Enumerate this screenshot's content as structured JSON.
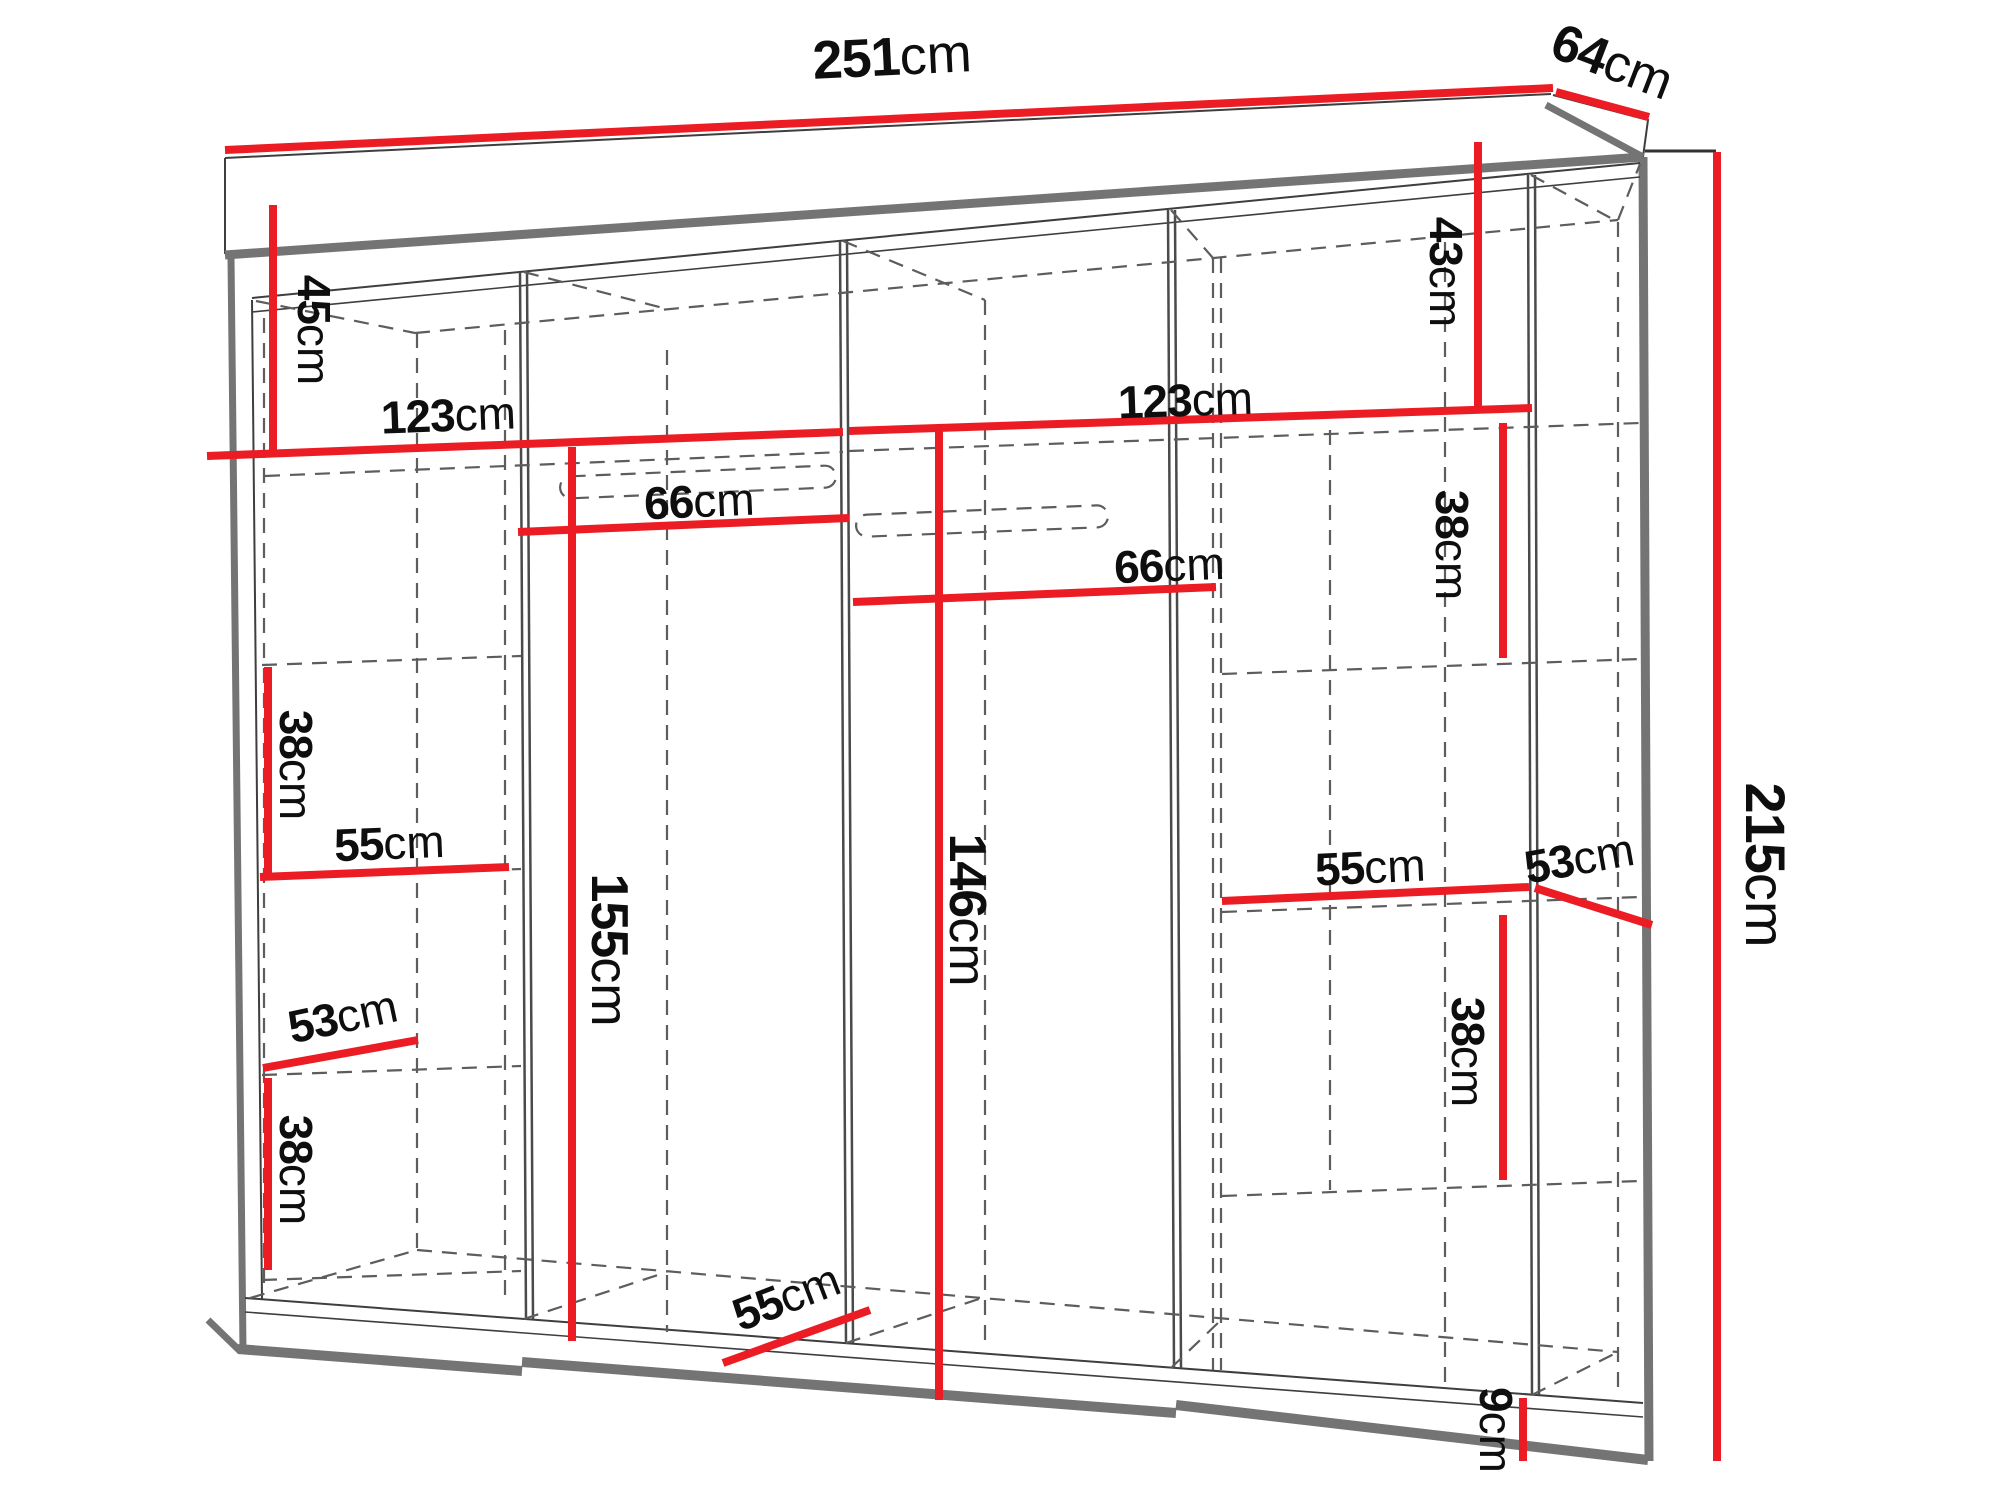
{
  "diagram": {
    "subject": "wardrobe-dimension-drawing",
    "unit": "cm"
  },
  "colors": {
    "dimension_line": "#ec1c24",
    "structure_thick": "#757575",
    "structure_thin": "#3e3e3e",
    "hidden_dashed": "#5d5d5d",
    "text": "#0e0e0e",
    "background": "#ffffff"
  },
  "dimensions": [
    {
      "id": "overall-width",
      "num": "251",
      "unit": "cm",
      "value_cm": 251,
      "line": [
        [
          225,
          150
        ],
        [
          1553,
          88
        ]
      ],
      "label": {
        "x": 893,
        "y": 75,
        "rot": -2.8,
        "size": 54
      }
    },
    {
      "id": "overall-depth",
      "num": "64",
      "unit": "cm",
      "value_cm": 64,
      "line": [
        [
          1556,
          92
        ],
        [
          1649,
          117
        ]
      ],
      "label": {
        "x": 1606,
        "y": 78,
        "rot": 21,
        "size": 52
      }
    },
    {
      "id": "overall-height",
      "num": "215",
      "unit": "cm",
      "value_cm": 215,
      "line": [
        [
          1717,
          152
        ],
        [
          1717,
          1461
        ]
      ],
      "tick": [
        [
          1645,
          151
        ],
        [
          1716,
          151
        ]
      ],
      "label": {
        "x": 1746,
        "y": 865,
        "rot": 90,
        "size": 56
      }
    },
    {
      "id": "top-left-45",
      "num": "45",
      "unit": "cm",
      "value_cm": 45,
      "line": [
        [
          273,
          205
        ],
        [
          273,
          453
        ]
      ],
      "label": {
        "x": 298,
        "y": 330,
        "rot": 90,
        "size": 46
      }
    },
    {
      "id": "top-right-43",
      "num": "43",
      "unit": "cm",
      "value_cm": 43,
      "line": [
        [
          1478,
          142
        ],
        [
          1478,
          410
        ]
      ],
      "label": {
        "x": 1430,
        "y": 272,
        "rot": 90,
        "size": 46
      }
    },
    {
      "id": "left-width-123",
      "num": "123",
      "unit": "cm",
      "value_cm": 123,
      "line": [
        [
          207,
          456
        ],
        [
          843,
          432
        ]
      ],
      "label": {
        "x": 449,
        "y": 431,
        "rot": -2.2,
        "size": 46
      }
    },
    {
      "id": "right-width-123",
      "num": "123",
      "unit": "cm",
      "value_cm": 123,
      "line": [
        [
          849,
          431
        ],
        [
          1532,
          408
        ]
      ],
      "label": {
        "x": 1186,
        "y": 416,
        "rot": -2,
        "size": 46
      }
    },
    {
      "id": "left-rail-66",
      "num": "66",
      "unit": "cm",
      "value_cm": 66,
      "line": [
        [
          518,
          532
        ],
        [
          849,
          518
        ]
      ],
      "label": {
        "x": 700,
        "y": 517,
        "rot": -2.4,
        "size": 46
      }
    },
    {
      "id": "right-rail-66",
      "num": "66",
      "unit": "cm",
      "value_cm": 66,
      "line": [
        [
          853,
          602
        ],
        [
          1216,
          587
        ]
      ],
      "label": {
        "x": 1170,
        "y": 581,
        "rot": -2.3,
        "size": 46
      }
    },
    {
      "id": "mid-height-155",
      "num": "155",
      "unit": "cm",
      "value_cm": 155,
      "line": [
        [
          572,
          447
        ],
        [
          572,
          1341
        ]
      ],
      "label": {
        "x": 592,
        "y": 950,
        "rot": 90,
        "size": 52
      }
    },
    {
      "id": "mid-height-146",
      "num": "146",
      "unit": "cm",
      "value_cm": 146,
      "line": [
        [
          939,
          427
        ],
        [
          939,
          1400
        ]
      ],
      "label": {
        "x": 950,
        "y": 910,
        "rot": 90,
        "size": 52
      }
    },
    {
      "id": "left-shelf-38-upper",
      "num": "38",
      "unit": "cm",
      "value_cm": 38,
      "line": [
        [
          268,
          667
        ],
        [
          268,
          875
        ]
      ],
      "label": {
        "x": 280,
        "y": 765,
        "rot": 90,
        "size": 46
      }
    },
    {
      "id": "left-shelf-55",
      "num": "55",
      "unit": "cm",
      "value_cm": 55,
      "line": [
        [
          260,
          877
        ],
        [
          509,
          867
        ]
      ],
      "label": {
        "x": 390,
        "y": 859,
        "rot": -2.3,
        "size": 46
      }
    },
    {
      "id": "left-depth-53",
      "num": "53",
      "unit": "cm",
      "value_cm": 53,
      "line": [
        [
          263,
          1068
        ],
        [
          418,
          1040
        ]
      ],
      "label": {
        "x": 346,
        "y": 1032,
        "rot": -12,
        "size": 46
      }
    },
    {
      "id": "left-shelf-38-lower",
      "num": "38",
      "unit": "cm",
      "value_cm": 38,
      "line": [
        [
          268,
          1078
        ],
        [
          268,
          1270
        ]
      ],
      "label": {
        "x": 280,
        "y": 1170,
        "rot": 90,
        "size": 46
      }
    },
    {
      "id": "bottom-depth-55",
      "num": "55",
      "unit": "cm",
      "value_cm": 55,
      "line": [
        [
          723,
          1363
        ],
        [
          870,
          1310
        ]
      ],
      "label": {
        "x": 792,
        "y": 1312,
        "rot": -21,
        "size": 46
      }
    },
    {
      "id": "right-shelf-55",
      "num": "55",
      "unit": "cm",
      "value_cm": 55,
      "line": [
        [
          1222,
          901
        ],
        [
          1529,
          887
        ]
      ],
      "label": {
        "x": 1371,
        "y": 883,
        "rot": -2.6,
        "size": 46
      }
    },
    {
      "id": "right-depth-53",
      "num": "53",
      "unit": "cm",
      "value_cm": 53,
      "line": [
        [
          1535,
          888
        ],
        [
          1652,
          925
        ]
      ],
      "label": {
        "x": 1582,
        "y": 874,
        "rot": -10,
        "size": 46
      }
    },
    {
      "id": "right-shelf-38-upper",
      "num": "38",
      "unit": "cm",
      "value_cm": 38,
      "line": [
        [
          1503,
          423
        ],
        [
          1503,
          658
        ]
      ],
      "label": {
        "x": 1436,
        "y": 545,
        "rot": 90,
        "size": 46
      }
    },
    {
      "id": "right-shelf-38-lower",
      "num": "38",
      "unit": "cm",
      "value_cm": 38,
      "line": [
        [
          1503,
          915
        ],
        [
          1503,
          1180
        ]
      ],
      "label": {
        "x": 1452,
        "y": 1052,
        "rot": 90,
        "size": 46
      }
    },
    {
      "id": "plinth-9",
      "num": "9",
      "unit": "cm",
      "value_cm": 9,
      "line": [
        [
          1523,
          1398
        ],
        [
          1523,
          1461
        ]
      ],
      "label": {
        "x": 1480,
        "y": 1430,
        "rot": 90,
        "size": 46
      }
    }
  ]
}
